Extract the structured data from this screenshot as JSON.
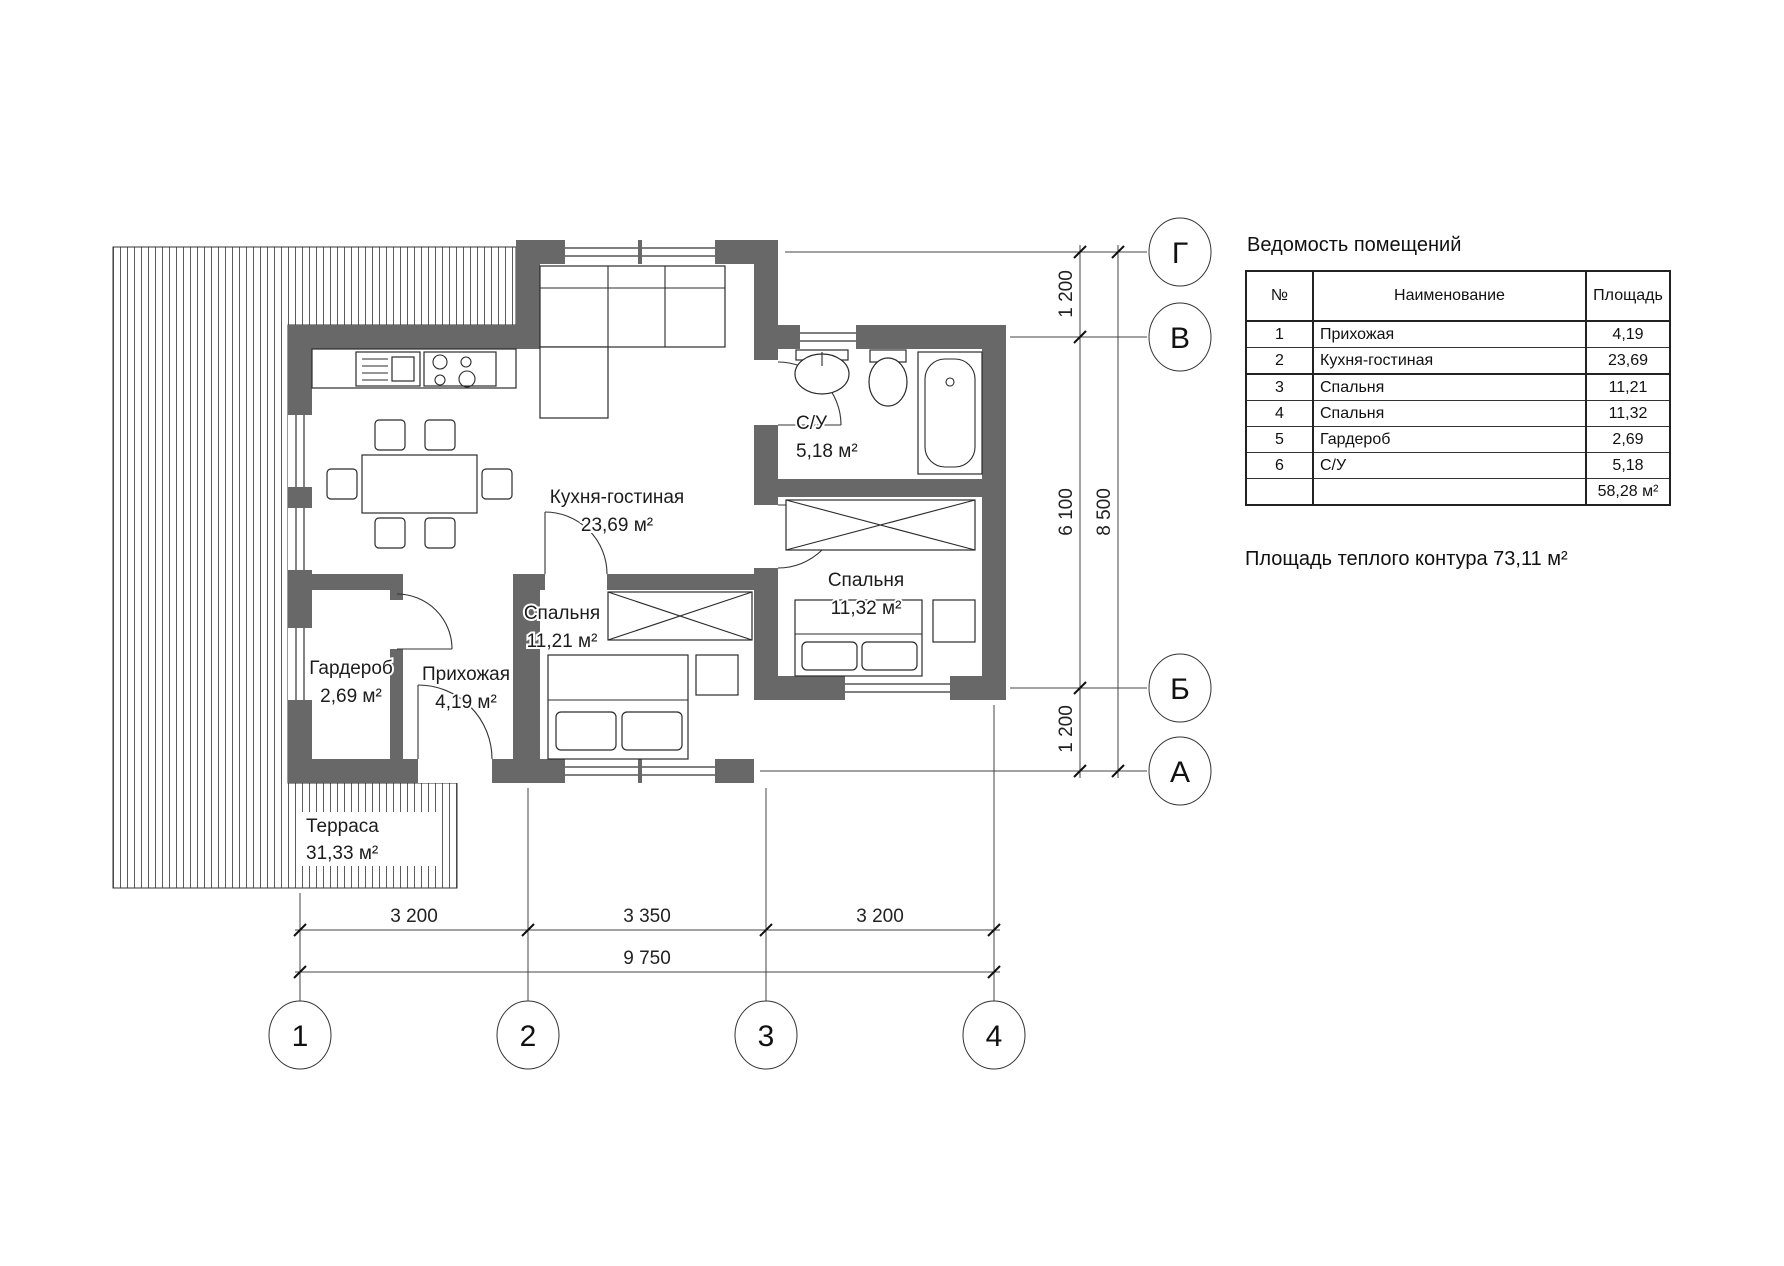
{
  "drawing": {
    "rooms": [
      {
        "name": "Кухня-гостиная",
        "area": "23,69 м²"
      },
      {
        "name": "С/У",
        "area": "5,18 м²"
      },
      {
        "name": "Спальня",
        "area": "11,32 м²"
      },
      {
        "name": "Спальня",
        "area": "11,21 м²"
      },
      {
        "name": "Прихожая",
        "area": "4,19 м²"
      },
      {
        "name": "Гардероб",
        "area": "2,69 м²"
      },
      {
        "name": "Терраса",
        "area": "31,33 м²"
      }
    ],
    "grid": {
      "columns": [
        "1",
        "2",
        "3",
        "4"
      ],
      "rows": [
        "Г",
        "В",
        "Б",
        "А"
      ]
    },
    "dimensions": {
      "bottom_segments": [
        "3 200",
        "3 350",
        "3 200"
      ],
      "bottom_total": "9 750",
      "right_segments": [
        "1 200",
        "6 100",
        "1 200"
      ],
      "right_total": "8 500"
    }
  },
  "schedule": {
    "title": "Ведомость помещений",
    "columns": [
      "№",
      "Наименование",
      "Площадь"
    ],
    "rows": [
      {
        "num": "1",
        "name": "Прихожая",
        "area": "4,19"
      },
      {
        "num": "2",
        "name": "Кухня-гостиная",
        "area": "23,69"
      },
      {
        "num": "3",
        "name": "Спальня",
        "area": "11,21"
      },
      {
        "num": "4",
        "name": "Спальня",
        "area": "11,32"
      },
      {
        "num": "5",
        "name": "Гардероб",
        "area": "2,69"
      },
      {
        "num": "6",
        "name": "С/У",
        "area": "5,18"
      }
    ],
    "total": "58,28 м²"
  },
  "notes": {
    "warm_contour": "Площадь теплого контура 73,11 м²"
  }
}
